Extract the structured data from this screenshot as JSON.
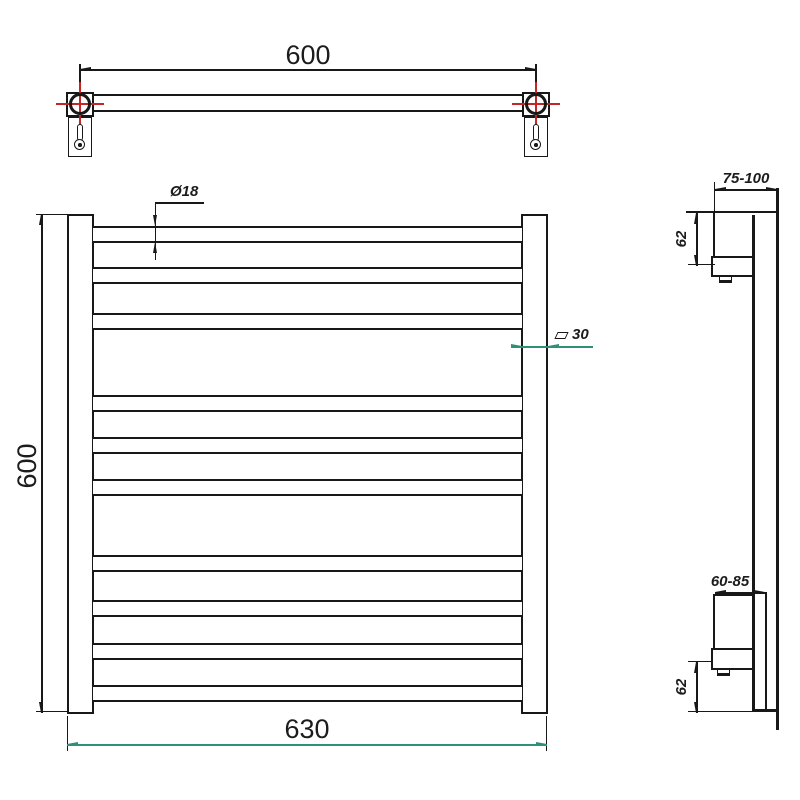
{
  "drawing": {
    "type": "technical-dimension-drawing",
    "subject": "ladder towel rail with wall mounting brackets",
    "colors": {
      "outline": "#181818",
      "dimension_accent": "#2f9078",
      "centerline_red": "#c52525",
      "background": "#ffffff"
    },
    "top_view": {
      "width_dim": "600"
    },
    "front_view": {
      "tube_diameter_dim": "Ø18",
      "profile_dim_symbol": "□",
      "profile_dim_value": "30",
      "height_dim": "600",
      "width_dim": "630",
      "rung_count": 10
    },
    "side_view": {
      "top_wall_offset_dim": "75-100",
      "top_bracket_height_dim": "62",
      "bottom_wall_offset_dim": "60-85",
      "bottom_bracket_height_dim": "62"
    }
  }
}
